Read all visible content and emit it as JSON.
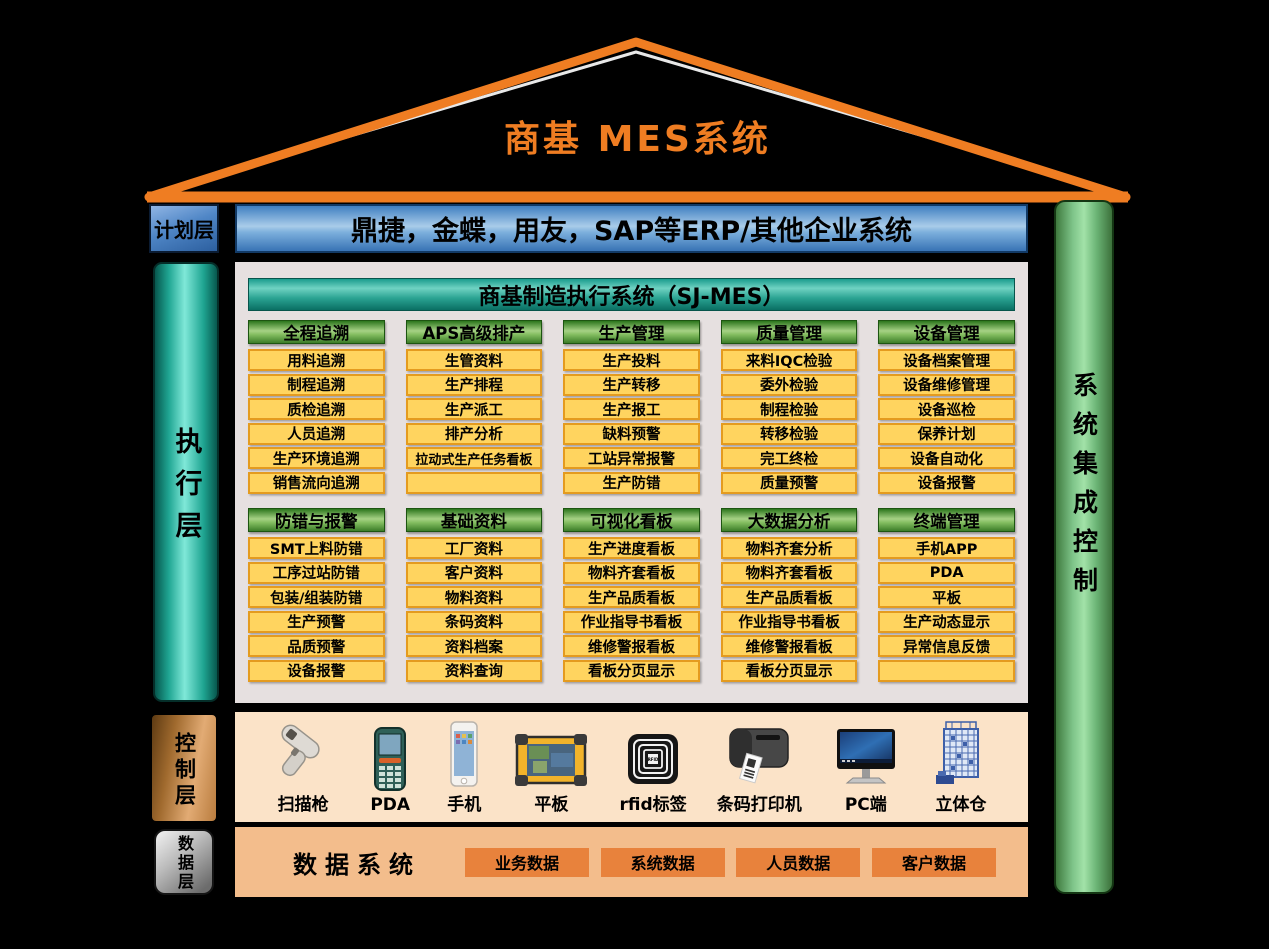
{
  "roof": {
    "title": "商基  MES系统"
  },
  "layers": {
    "plan": "计划层",
    "exec": "执行层",
    "control": "控制层",
    "data": "数据层"
  },
  "erp_bar": "鼎捷，金蝶，用友，SAP等ERP/其他企业系统",
  "right_pillar": "系统集成控制",
  "mes_panel": {
    "title": "商基制造执行系统（SJ-MES）",
    "rows": [
      [
        {
          "header": "全程追溯",
          "items": [
            "用料追溯",
            "制程追溯",
            "质检追溯",
            "人员追溯",
            "生产环境追溯",
            "销售流向追溯"
          ]
        },
        {
          "header": "APS高级排产",
          "items": [
            "生管资料",
            "生产排程",
            "生产派工",
            "排产分析",
            "拉动式生产任务看板",
            ""
          ]
        },
        {
          "header": "生产管理",
          "items": [
            "生产投料",
            "生产转移",
            "生产报工",
            "缺料预警",
            "工站异常报警",
            "生产防错"
          ]
        },
        {
          "header": "质量管理",
          "items": [
            "来料IQC检验",
            "委外检验",
            "制程检验",
            "转移检验",
            "完工终检",
            "质量预警"
          ]
        },
        {
          "header": "设备管理",
          "items": [
            "设备档案管理",
            "设备维修管理",
            "设备巡检",
            "保养计划",
            "设备自动化",
            "设备报警"
          ]
        }
      ],
      [
        {
          "header": "防错与报警",
          "items": [
            "SMT上料防错",
            "工序过站防错",
            "包装/组装防错",
            "生产预警",
            "品质预警",
            "设备报警"
          ]
        },
        {
          "header": "基础资料",
          "items": [
            "工厂资料",
            "客户资料",
            "物料资料",
            "条码资料",
            "资料档案",
            "资料查询"
          ]
        },
        {
          "header": "可视化看板",
          "items": [
            "生产进度看板",
            "物料齐套看板",
            "生产品质看板",
            "作业指导书看板",
            "维修警报看板",
            "看板分页显示"
          ]
        },
        {
          "header": "大数据分析",
          "items": [
            "物料齐套分析",
            "物料齐套看板",
            "生产品质看板",
            "作业指导书看板",
            "维修警报看板",
            "看板分页显示"
          ]
        },
        {
          "header": "终端管理",
          "items": [
            "手机APP",
            "PDA",
            "平板",
            "生产动态显示",
            "异常信息反馈",
            ""
          ]
        }
      ]
    ]
  },
  "control_layer": {
    "devices": [
      {
        "icon": "barcode-scanner-icon",
        "label": "扫描枪"
      },
      {
        "icon": "pda-icon",
        "label": "PDA"
      },
      {
        "icon": "smartphone-icon",
        "label": "手机"
      },
      {
        "icon": "rugged-tablet-icon",
        "label": "平板"
      },
      {
        "icon": "rfid-tag-icon",
        "label": "rfid标签"
      },
      {
        "icon": "barcode-printer-icon",
        "label": "条码打印机"
      },
      {
        "icon": "pc-monitor-icon",
        "label": "PC端"
      },
      {
        "icon": "warehouse-icon",
        "label": "立体仓"
      }
    ]
  },
  "data_layer": {
    "title": "数据系统",
    "boxes": [
      "业务数据",
      "系统数据",
      "人员数据",
      "客户数据"
    ]
  },
  "colors": {
    "accent_orange": "#EF7D22",
    "erp_blue": "#5B9BD5",
    "teal": "#17998A",
    "header_green": "#70AD47",
    "item_yellow": "#FFD45F",
    "item_border": "#E49B1F",
    "control_band_peach": "#FBE3C8",
    "data_band_orange": "#F3BD8C",
    "data_box_orange": "#E8823C"
  }
}
